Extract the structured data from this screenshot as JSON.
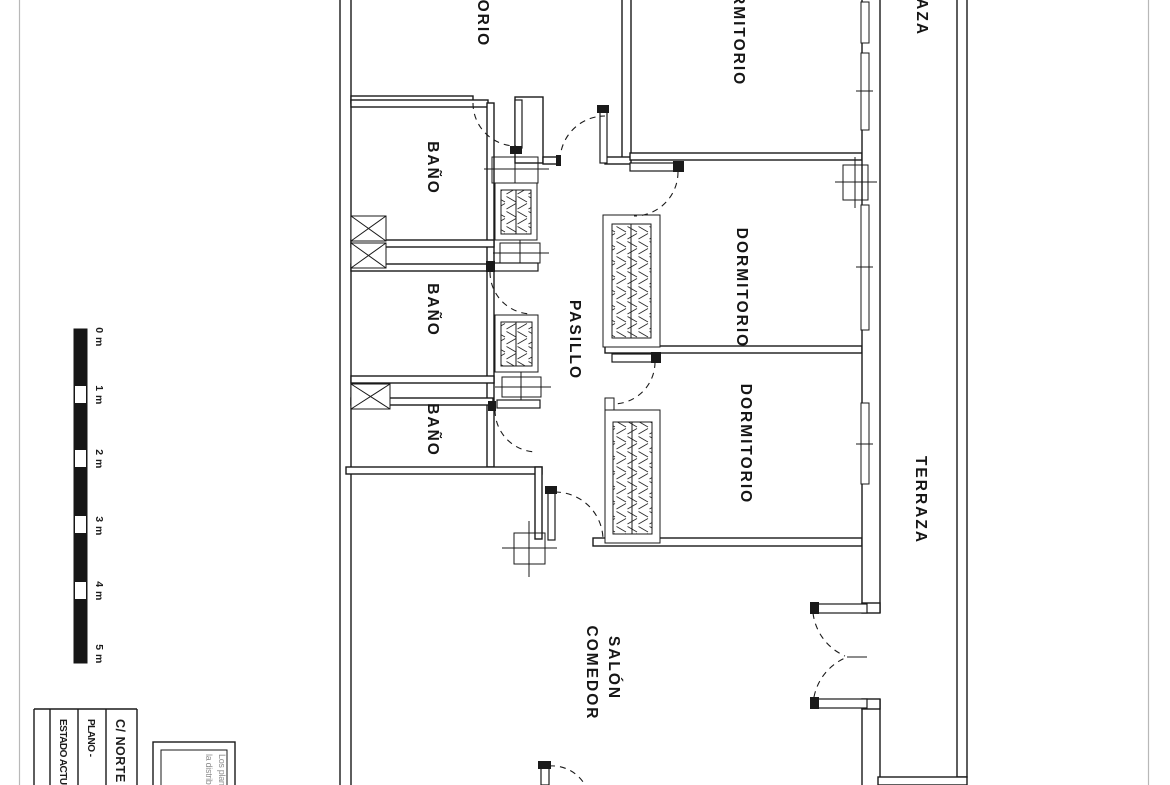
{
  "plan": {
    "rooms": {
      "dormitorio_top_left": "DORMITORIO",
      "dormitorio_top": "DORMITORIO",
      "dormitorio_mid": "DORMITORIO",
      "dormitorio_bottom": "DORMITORIO",
      "bano_1": "BAÑO",
      "bano_2": "BAÑO",
      "bano_3": "BAÑO",
      "pasillo": "PASILLO",
      "salon_line1": "SALÓN",
      "salon_line2": "COMEDOR",
      "terraza_top": "TERRAZA",
      "terraza": "TERRAZA"
    }
  },
  "scale_bar": {
    "labels": [
      "0 m",
      "1 m",
      "2 m",
      "3 m",
      "4 m",
      "5 m"
    ]
  },
  "title_block": {
    "estado": "ESTADO ACTUAL",
    "plano": "PLANO - ",
    "street": "C/ NORTE"
  },
  "note_box": {
    "line1": "Los planos",
    "line2": "la distribución"
  },
  "colors": {
    "ink": "#1a1a1a",
    "sheet_border": "#b8b8b8",
    "note_text": "#8f8f8f",
    "paper": "#ffffff"
  }
}
